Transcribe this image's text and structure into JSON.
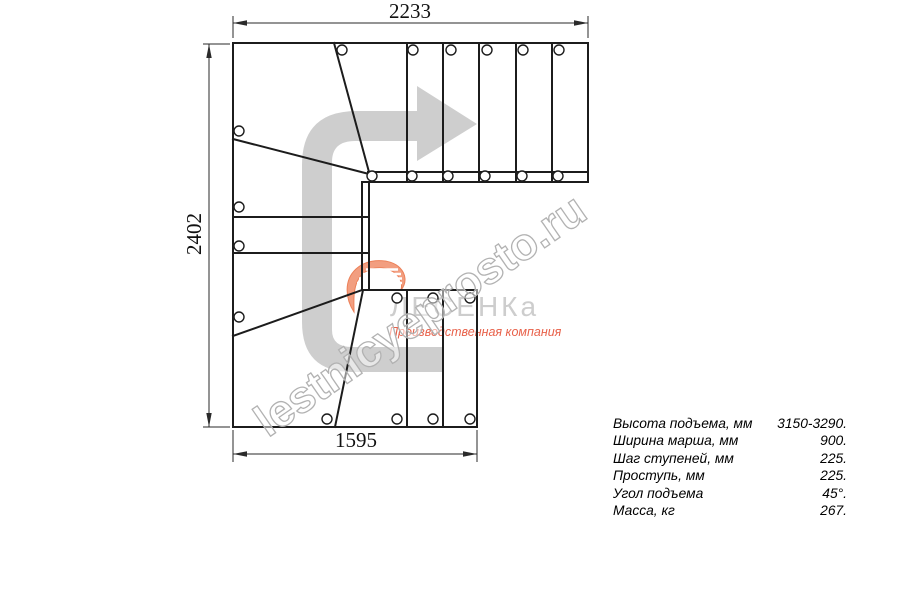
{
  "drawing": {
    "top_width_mm": "2233",
    "left_height_mm": "2402",
    "bottom_width_mm": "1595"
  },
  "watermark": {
    "text": "lestnicyeprosto.ru"
  },
  "logo": {
    "name": "ЛЕСЕНКа",
    "tagline": "Производственная компания",
    "accent_color": "#ec7a50",
    "name_color": "#cdcdcd"
  },
  "specs": {
    "rows": [
      {
        "label": "Высота подъема, мм",
        "value": "3150-3290."
      },
      {
        "label": "Ширина марша, мм",
        "value": "900."
      },
      {
        "label": "Шаг ступеней, мм",
        "value": "225."
      },
      {
        "label": "Проступь, мм",
        "value": "225."
      },
      {
        "label": "Угол подъема",
        "value": "45°."
      },
      {
        "label": "Масса, кг",
        "value": "267."
      }
    ]
  },
  "colors": {
    "line": "#1c1c1c",
    "direction_arrow_gray": "#cdcdcd"
  }
}
